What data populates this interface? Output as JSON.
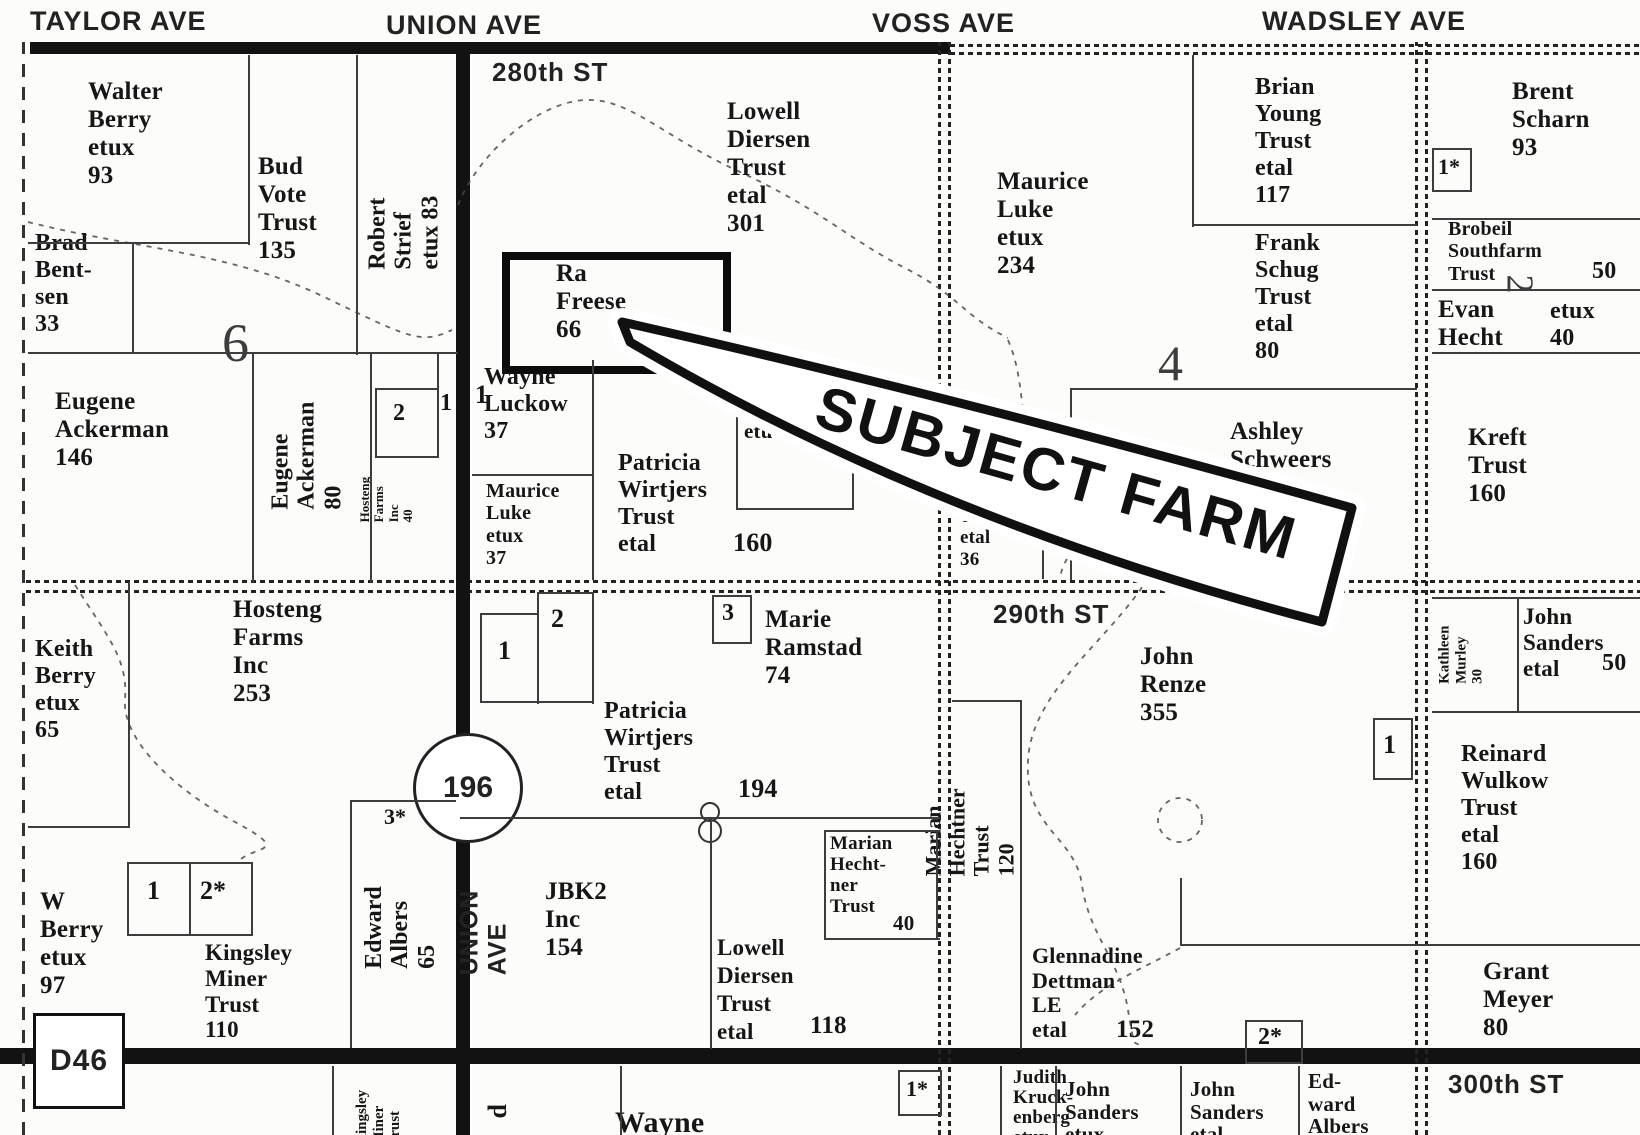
{
  "map_title": "County plat map with subject farm annotation",
  "annotation": {
    "subject_label": "SUBJECT FARM"
  },
  "roads": {
    "avenues": {
      "taylor": "TAYLOR AVE",
      "union": "UNION AVE",
      "voss": "VOSS AVE",
      "wadsley": "WADSLEY AVE"
    },
    "streets": {
      "s280": "280th ST",
      "s290": "290th ST",
      "s300": "300th ST"
    },
    "union_vertical": "UNION AVE",
    "highway_marker": "196",
    "county_road_sign": "D46"
  },
  "section_numbers": {
    "sec6": "6",
    "sec4": "4",
    "sec2": "2"
  },
  "labels": {
    "walter_berry": {
      "owner": "Walter Berry etux",
      "acres": "93",
      "text": "Walter\nBerry\netux\n93"
    },
    "bud_vote": {
      "owner": "Bud Vote Trust",
      "acres": "135",
      "text": "Bud\nVote\nTrust\n135"
    },
    "robert_strief": {
      "owner": "Robert Strief etux",
      "acres": "83",
      "text": "Robert\nStrief\netux 83"
    },
    "brad_bentsen": {
      "owner": "Brad Bentsen",
      "acres": "33",
      "text": "Brad\nBent-\nsen\n33"
    },
    "eugene_ackerman_146": {
      "owner": "Eugene Ackerman",
      "acres": "146",
      "text": "Eugene\nAckerman\n146"
    },
    "eugene_ackerman_80": {
      "owner": "Eugene Ackerman",
      "acres": "80",
      "text": "Eugene\nAckerman\n80"
    },
    "hosteng_40": {
      "owner": "Hosteng Farms Inc",
      "acres": "40",
      "text": "Hosteng\nFarms\nInc\n40"
    },
    "lowell_diersen_301": {
      "owner": "Lowell Diersen Trust etal",
      "acres": "301",
      "text": "Lowell\nDiersen\nTrust\netal\n301"
    },
    "ra_freese": {
      "owner": "Ra Freese",
      "acres": "66",
      "text": "Ra\nFreese\n66"
    },
    "wayne_luckow": {
      "owner": "Wayne Luckow",
      "acres": "37",
      "text": "Wayne\nLuckow\n37"
    },
    "maurice_luke_37": {
      "owner": "Maurice Luke etux",
      "acres": "37",
      "text": "Maurice\nLuke\netux\n37"
    },
    "patricia_wirtjers_160": {
      "owner": "Patricia Wirtjers Trust etal",
      "acres": "160",
      "text": "Patricia\nWirtjers\nTrust\netal"
    },
    "patricia_wirtjers_160_acres": {
      "text": "160"
    },
    "obscured_owner": {
      "owner": "partially hidden by arrow",
      "text": "L\netu"
    },
    "trust_36": {
      "owner": "Trust etal (name hidden by arrow)",
      "acres": "36",
      "text": "Trust\netal\n36"
    },
    "maurice_luke_234": {
      "owner": "Maurice Luke etux",
      "acres": "234",
      "text": "Maurice\nLuke\netux\n234"
    },
    "brian_young": {
      "owner": "Brian Young Trust etal",
      "acres": "117",
      "text": "Brian\nYoung\nTrust\netal\n117"
    },
    "frank_schug": {
      "owner": "Frank Schug Trust etal",
      "acres": "80",
      "text": "Frank\nSchug\nTrust\netal\n80"
    },
    "ashley_schweers": {
      "owner": "Ashley Schweers",
      "acres": "154",
      "text": "Ashley\nSchweers\n154"
    },
    "brent_scharn": {
      "owner": "Brent Scharn",
      "acres": "93",
      "text": "Brent\nScharn\n93"
    },
    "brobeil": {
      "owner": "Brobeil Southfarm Trust",
      "acres": "50",
      "text": "Brobeil\nSouthfarm\nTrust"
    },
    "brobeil_acres": {
      "text": "50"
    },
    "evan_hecht": {
      "owner": "Evan Hecht etux",
      "acres": "40",
      "text": "Evan\nHecht"
    },
    "evan_hecht_col2": {
      "text": "etux\n  40"
    },
    "kreft": {
      "owner": "Kreft Trust",
      "acres": "160",
      "text": "Kreft\nTrust\n160"
    },
    "keith_berry": {
      "owner": "Keith Berry etux",
      "acres": "65",
      "text": "Keith\nBerry\netux\n65"
    },
    "hosteng_253": {
      "owner": "Hosteng Farms Inc",
      "acres": "253",
      "text": "Hosteng\nFarms\nInc\n253"
    },
    "w_berry": {
      "owner": "W Berry etux",
      "acres": "97",
      "text": "W\nBerry\netux\n97"
    },
    "kingsley_110": {
      "owner": "Kingsley Miner Trust",
      "acres": "110",
      "text": "Kingsley\nMiner\nTrust\n110"
    },
    "edward_albers_65": {
      "owner": "Edward Albers",
      "acres": "65",
      "text": "Edward\nAlbers\n65"
    },
    "marie_ramstad": {
      "owner": "Marie Ramstad",
      "acres": "74",
      "text": "Marie\nRamstad\n74"
    },
    "patricia_wirtjers_194": {
      "owner": "Patricia Wirtjers Trust etal",
      "acres": "194",
      "text": "Patricia\nWirtjers\nTrust\netal"
    },
    "patricia_wirtjers_194_acres": {
      "text": "194"
    },
    "jbk2": {
      "owner": "JBK2 Inc",
      "acres": "154",
      "text": "JBK2\nInc\n154"
    },
    "lowell_diersen_118": {
      "owner": "Lowell Diersen Trust etal",
      "acres": "118",
      "text": "Lowell\nDiersen\nTrust\netal"
    },
    "lowell_diersen_118_acres": {
      "text": "118"
    },
    "marian_hechtner_40": {
      "owner": "Marian Hechtner Trust",
      "acres": "40",
      "text": "Marian\nHecht-\nner\nTrust"
    },
    "marian_hechtner_40_acres": {
      "text": "40"
    },
    "marian_hechtner_120": {
      "owner": "Marian Hechtner Trust",
      "acres": "120",
      "text": "Marian\nHechtner\nTrust\n120"
    },
    "john_renze": {
      "owner": "John Renze",
      "acres": "355",
      "text": "John\nRenze\n355"
    },
    "glennadine": {
      "owner": "Glennadine Dettman LE etal",
      "acres": "152",
      "text": "Glennadine\nDettman\nLE\netal"
    },
    "glennadine_acres": {
      "text": "152"
    },
    "kathleen_murley": {
      "owner": "Kathleen Murley",
      "acres": "30",
      "text": "Kathleen\nMurley\n30"
    },
    "john_sanders_50": {
      "owner": "John Sanders etal",
      "acres": "50",
      "text": "John\nSanders\netal"
    },
    "john_sanders_50_acres": {
      "text": "50"
    },
    "reinard_wulkow": {
      "owner": "Reinard Wulkow Trust etal",
      "acres": "160",
      "text": "Reinard\nWulkow\nTrust\netal\n160"
    },
    "grant_meyer": {
      "owner": "Grant Meyer",
      "acres": "80",
      "text": "Grant\nMeyer\n80"
    },
    "judith_kruckenberg": {
      "owner": "Judith Kruckenberg etux",
      "text": "Judith\nKruck-\nenberg\netux"
    },
    "john_sanders_etux": {
      "owner": "John Sanders etux",
      "text": "John\nSanders\netux"
    },
    "john_sanders_etal": {
      "owner": "John Sanders etal",
      "text": "John\nSanders\netal"
    },
    "edward_albers_bottom": {
      "owner": "Edward Albers",
      "text": "Ed-\nward\nAlbers"
    },
    "wayne_partial": {
      "owner": "Wayne (cut off)",
      "text": "Wayne"
    },
    "kingsley_partial": {
      "owner": "Kingsley Miner Trust (cut off)",
      "text": "Kingsley\nMiner\nTrust"
    },
    "d_fragment": {
      "text": "d"
    },
    "m1a": {
      "text": "1"
    },
    "m2a": {
      "text": "2"
    },
    "m1b": {
      "text": "1"
    },
    "m1c": {
      "text": "1"
    },
    "m2star_a": {
      "text": "2*"
    },
    "m3star": {
      "text": "3*"
    },
    "m1_mid": {
      "text": "1"
    },
    "m2_mid": {
      "text": "2"
    },
    "m3_mid": {
      "text": "3"
    },
    "m1star_top": {
      "text": "1*"
    },
    "m1star_bottom": {
      "text": "1*"
    },
    "m2star_b": {
      "text": "2*"
    },
    "m1d": {
      "text": "1"
    }
  }
}
